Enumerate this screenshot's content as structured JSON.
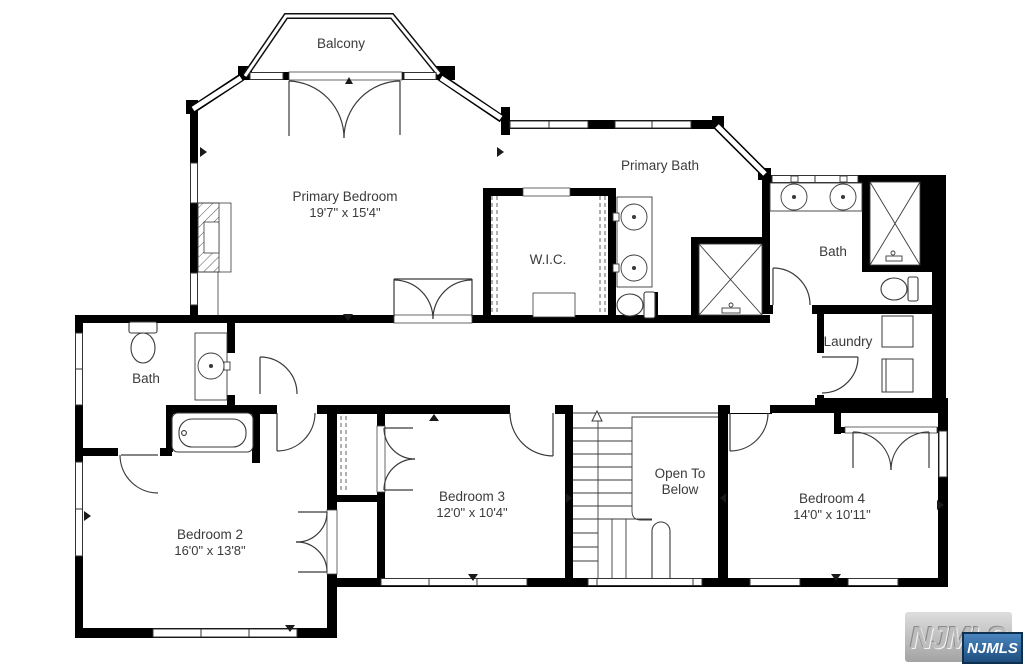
{
  "plan": {
    "balcony": {
      "label": "Balcony"
    },
    "primary_bedroom": {
      "label": "Primary Bedroom",
      "dims": "19'7\" x 15'4\""
    },
    "primary_bath": {
      "label": "Primary Bath"
    },
    "wic": {
      "label": "W.I.C."
    },
    "bath_right": {
      "label": "Bath"
    },
    "laundry": {
      "label": "Laundry"
    },
    "bath_left": {
      "label": "Bath"
    },
    "bedroom2": {
      "label": "Bedroom 2",
      "dims": "16'0\" x 13'8\""
    },
    "bedroom3": {
      "label": "Bedroom 3",
      "dims": "12'0\" x 10'4\""
    },
    "open_below": {
      "line1": "Open To",
      "line2": "Below"
    },
    "bedroom4": {
      "label": "Bedroom 4",
      "dims": "14'0\" x 10'11\""
    }
  },
  "watermark": {
    "embossed_text": "NJMLS",
    "badge_text": "NJMLS",
    "badge_color": "#2d6cab",
    "badge_border": "#0e2f4d"
  },
  "colors": {
    "wall": "#000000",
    "line": "#3a3a3a",
    "text": "#3b3b3b"
  }
}
